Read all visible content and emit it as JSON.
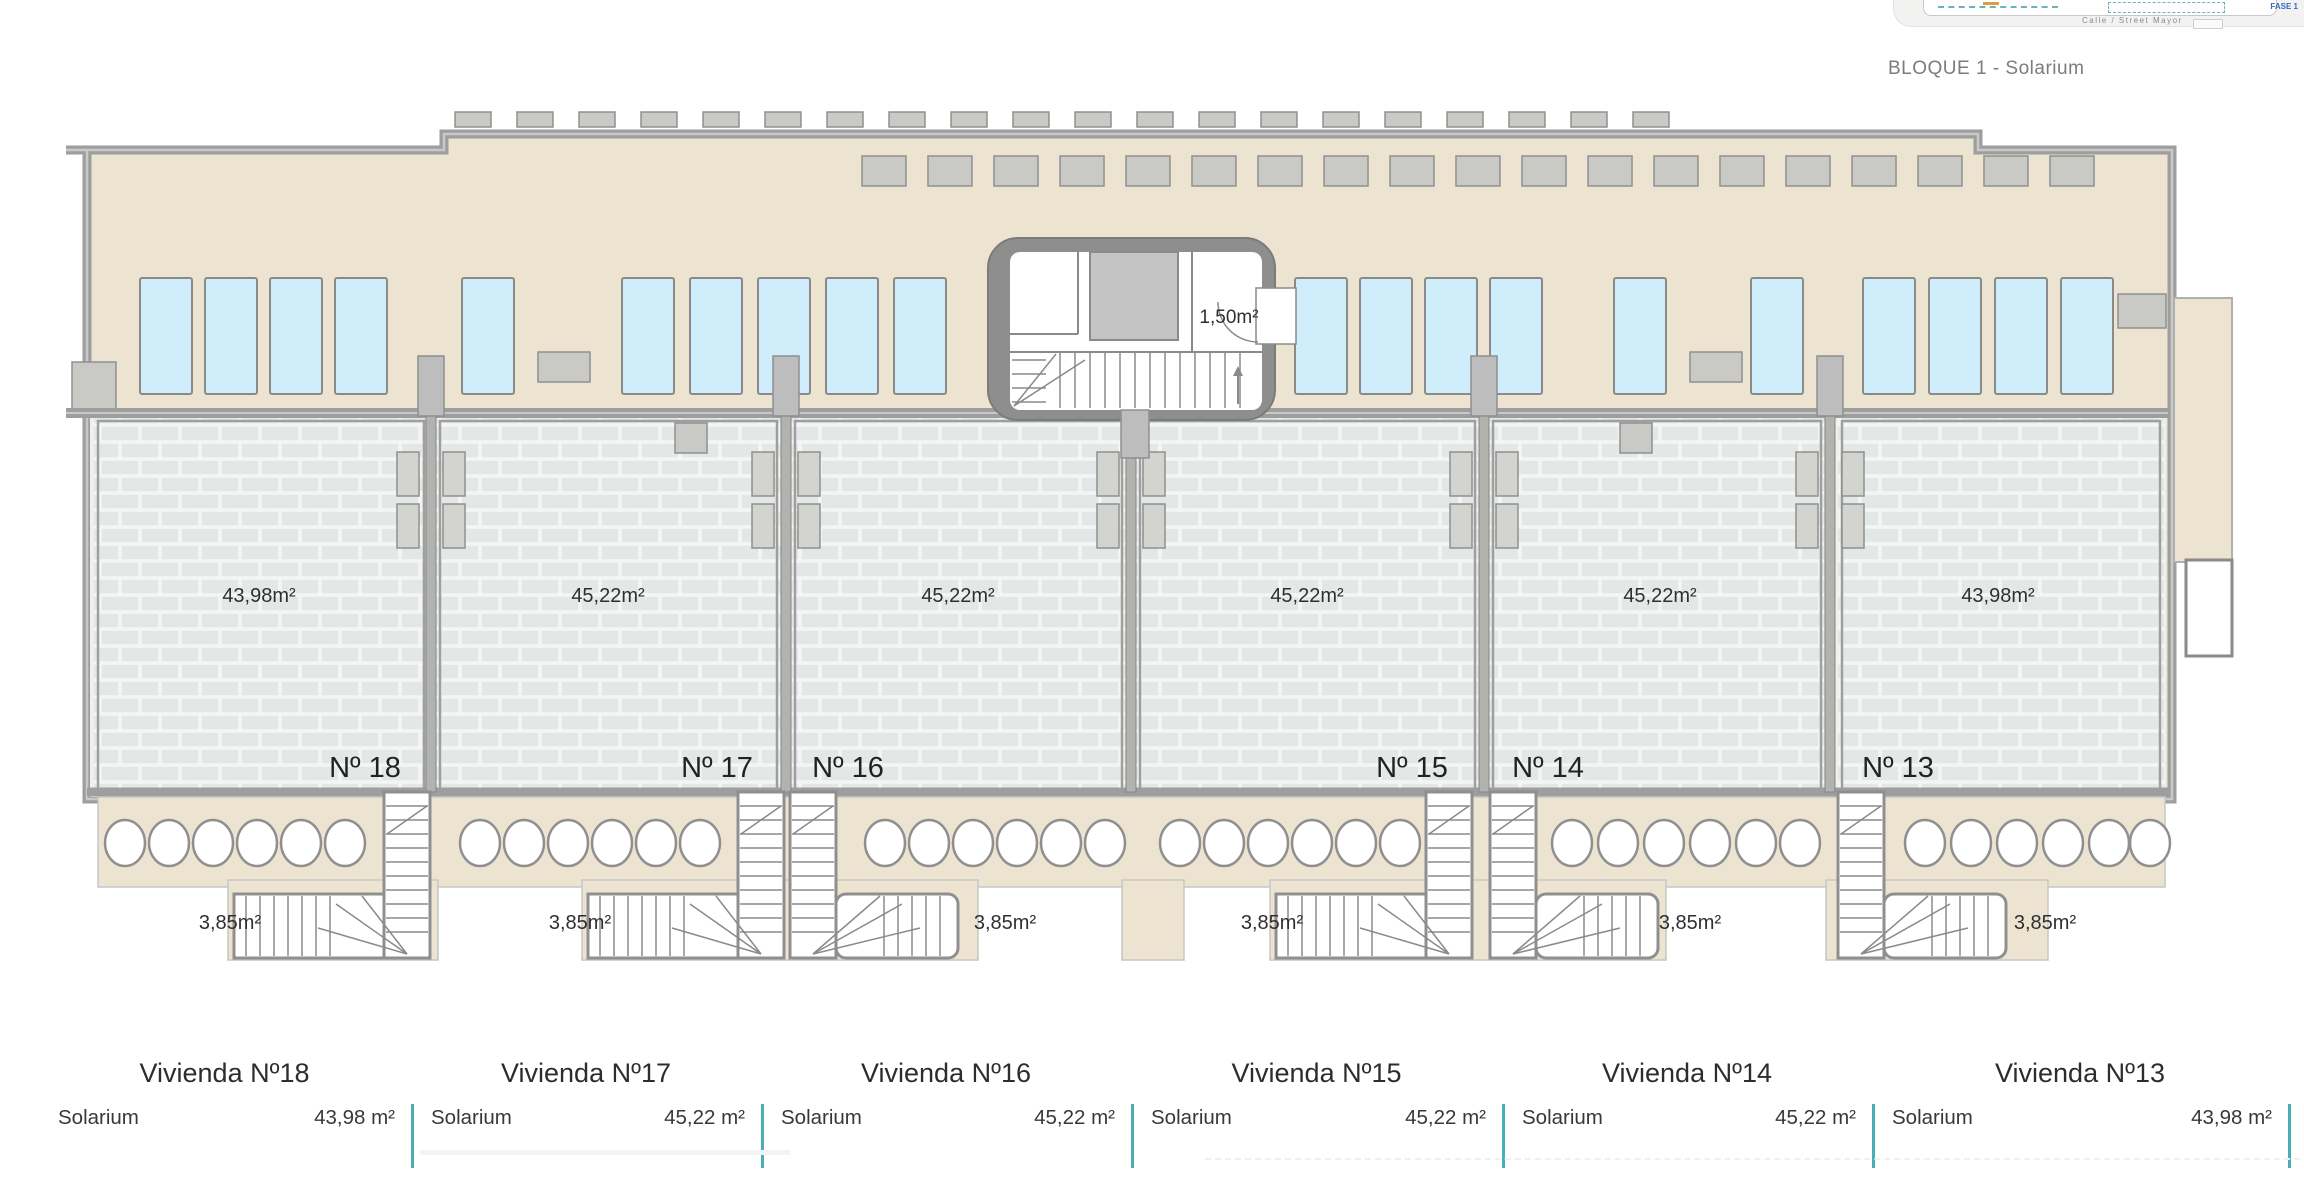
{
  "page": {
    "title": "BLOQUE 1 - Solarium"
  },
  "inset": {
    "street_label": "Calle / Street Mayor",
    "phase_label": "FASE 1"
  },
  "core": {
    "area_label": "1,50m²"
  },
  "units": [
    {
      "id": "18",
      "number": "Nº 18",
      "area": "43,98m²",
      "stair_area": "3,85m²",
      "table": {
        "name": "Vivienda Nº18",
        "row_label": "Solarium",
        "row_value": "43,98 m²"
      }
    },
    {
      "id": "17",
      "number": "Nº 17",
      "area": "45,22m²",
      "stair_area": "3,85m²",
      "table": {
        "name": "Vivienda Nº17",
        "row_label": "Solarium",
        "row_value": "45,22 m²"
      }
    },
    {
      "id": "16",
      "number": "Nº 16",
      "area": "45,22m²",
      "stair_area": "3,85m²",
      "table": {
        "name": "Vivienda Nº16",
        "row_label": "Solarium",
        "row_value": "45,22 m²"
      }
    },
    {
      "id": "15",
      "number": "Nº 15",
      "area": "45,22m²",
      "stair_area": "3,85m²",
      "table": {
        "name": "Vivienda Nº15",
        "row_label": "Solarium",
        "row_value": "45,22 m²"
      }
    },
    {
      "id": "14",
      "number": "Nº 14",
      "area": "45,22m²",
      "stair_area": "3,85m²",
      "table": {
        "name": "Vivienda Nº14",
        "row_label": "Solarium",
        "row_value": "45,22 m²"
      }
    },
    {
      "id": "13",
      "number": "Nº 13",
      "area": "43,98m²",
      "stair_area": "3,85m²",
      "table": {
        "name": "Vivienda Nº13",
        "row_label": "Solarium",
        "row_value": "43,98 m²"
      }
    }
  ],
  "colors": {
    "accent_teal": "#49aeb6",
    "phase_blue": "#3a66c4",
    "terrace_beige": "#ece4d1",
    "pool_blue": "#cfedfb",
    "wall_gray": "#9e9e9e"
  }
}
